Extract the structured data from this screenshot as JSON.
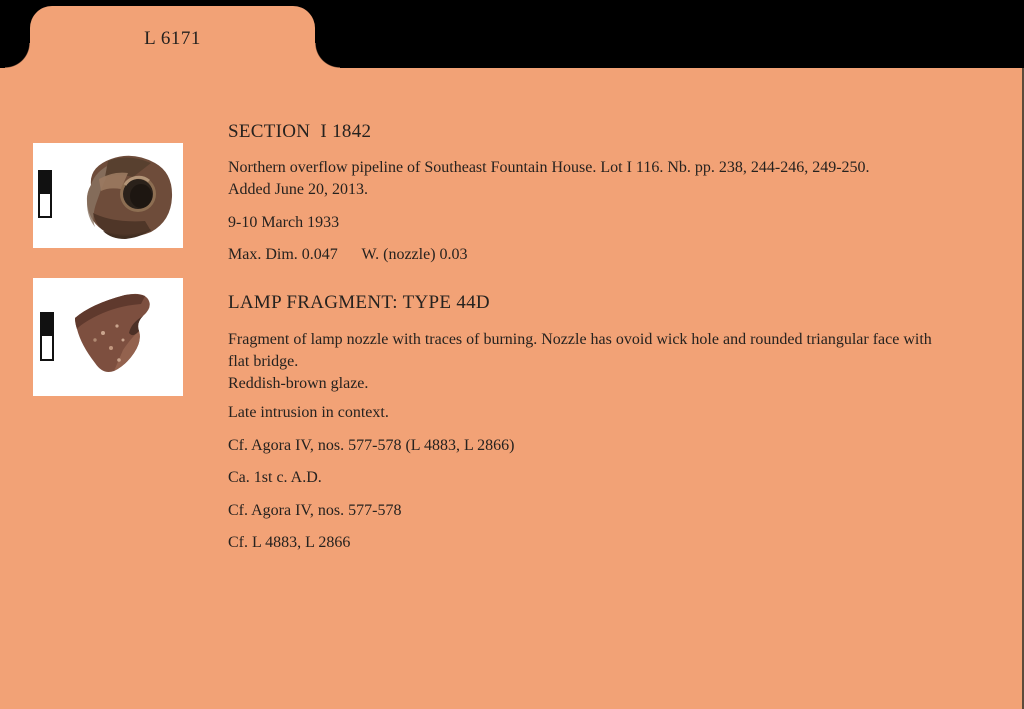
{
  "card": {
    "tab_label": "L 6171",
    "bg_color": "#F2A276",
    "surround_color": "#000000",
    "text_color": "#26221f"
  },
  "photos": [
    {
      "name": "lamp-fragment-top-view",
      "scale_bar": "black-and-white scale bar"
    },
    {
      "name": "lamp-fragment-side-view",
      "scale_bar": "black-and-white scale bar"
    }
  ],
  "sections": [
    {
      "heading": "SECTION  I 1842",
      "description": "Northern overflow pipeline of Southeast Fountain House. Lot I 116. Nb. pp. 238, 244-246, 249-250.\nAdded June 20, 2013.",
      "date": "9-10 March 1933",
      "dimensions": "Max. Dim. 0.047      W. (nozzle) 0.03"
    },
    {
      "heading": "LAMP FRAGMENT: TYPE 44D",
      "description": "Fragment of lamp nozzle with traces of burning. Nozzle has ovoid wick hole and rounded triangular face with flat bridge.\nReddish-brown glaze.",
      "notes": [
        "Late intrusion in context.",
        "Cf. Agora IV, nos. 577-578 (L 4883, L 2866)",
        "Ca. 1st c. A.D.",
        "Cf. Agora IV, nos. 577-578",
        "Cf. L 4883, L 2866"
      ]
    }
  ]
}
